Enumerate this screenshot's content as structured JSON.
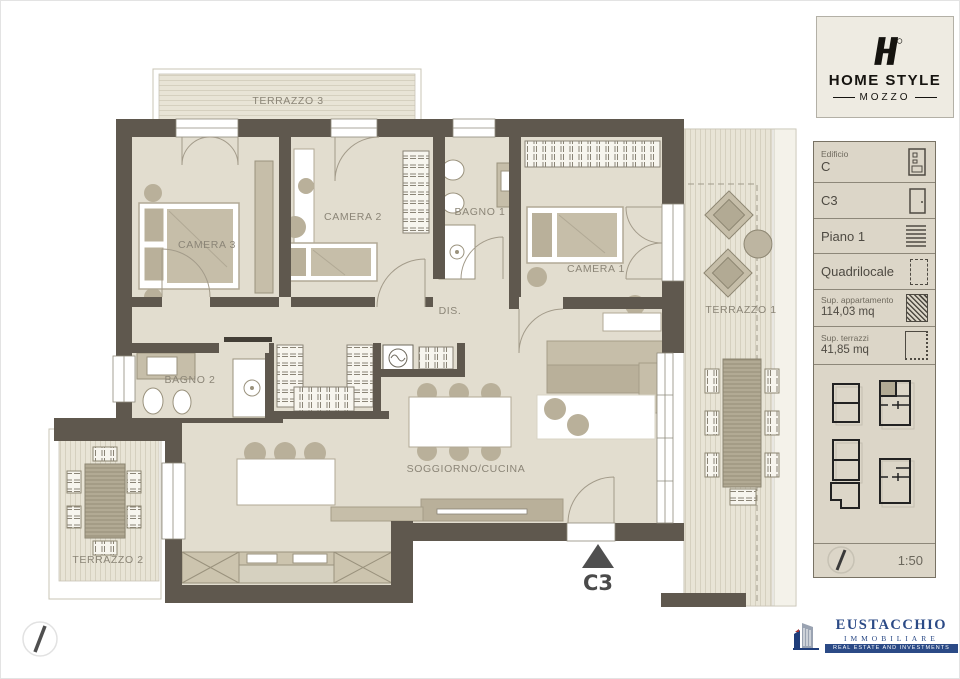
{
  "logo": {
    "line1": "HOME STYLE",
    "line2": "MOZZO"
  },
  "panel": {
    "edificio_label": "Edificio",
    "edificio_value": "C",
    "unit": "C3",
    "floor": "Piano 1",
    "type": "Quadrilocale",
    "sup_app_label": "Sup. appartamento",
    "sup_app_value": "114,03 mq",
    "sup_ter_label": "Sup. terrazzi",
    "sup_ter_value": "41,85 mq",
    "scale": "1:50"
  },
  "plan": {
    "rooms": [
      {
        "id": "terrazzo3",
        "label": "TERRAZZO 3"
      },
      {
        "id": "camera3",
        "label": "CAMERA 3"
      },
      {
        "id": "camera2",
        "label": "CAMERA 2"
      },
      {
        "id": "bagno1",
        "label": "BAGNO 1"
      },
      {
        "id": "camera1",
        "label": "CAMERA 1"
      },
      {
        "id": "dis",
        "label": "DIS."
      },
      {
        "id": "bagno2",
        "label": "BAGNO 2"
      },
      {
        "id": "soggiorno",
        "label": "SOGGIORNO/CUCINA"
      },
      {
        "id": "terrazzo1",
        "label": "TERRAZZO 1"
      },
      {
        "id": "terrazzo2",
        "label": "TERRAZZO 2"
      }
    ],
    "unit_marker": "C3"
  },
  "footer": {
    "brand": "EUSTACCHIO",
    "brand2": "IMMOBILIARE",
    "tagline": "REAL ESTATE AND INVESTMENTS"
  },
  "colors": {
    "wall": "#5f584e",
    "floor": "#e2ddcf",
    "deck": "#e8e4d6",
    "furniture": "#c6bea9",
    "brand_blue": "#2b4a86"
  }
}
